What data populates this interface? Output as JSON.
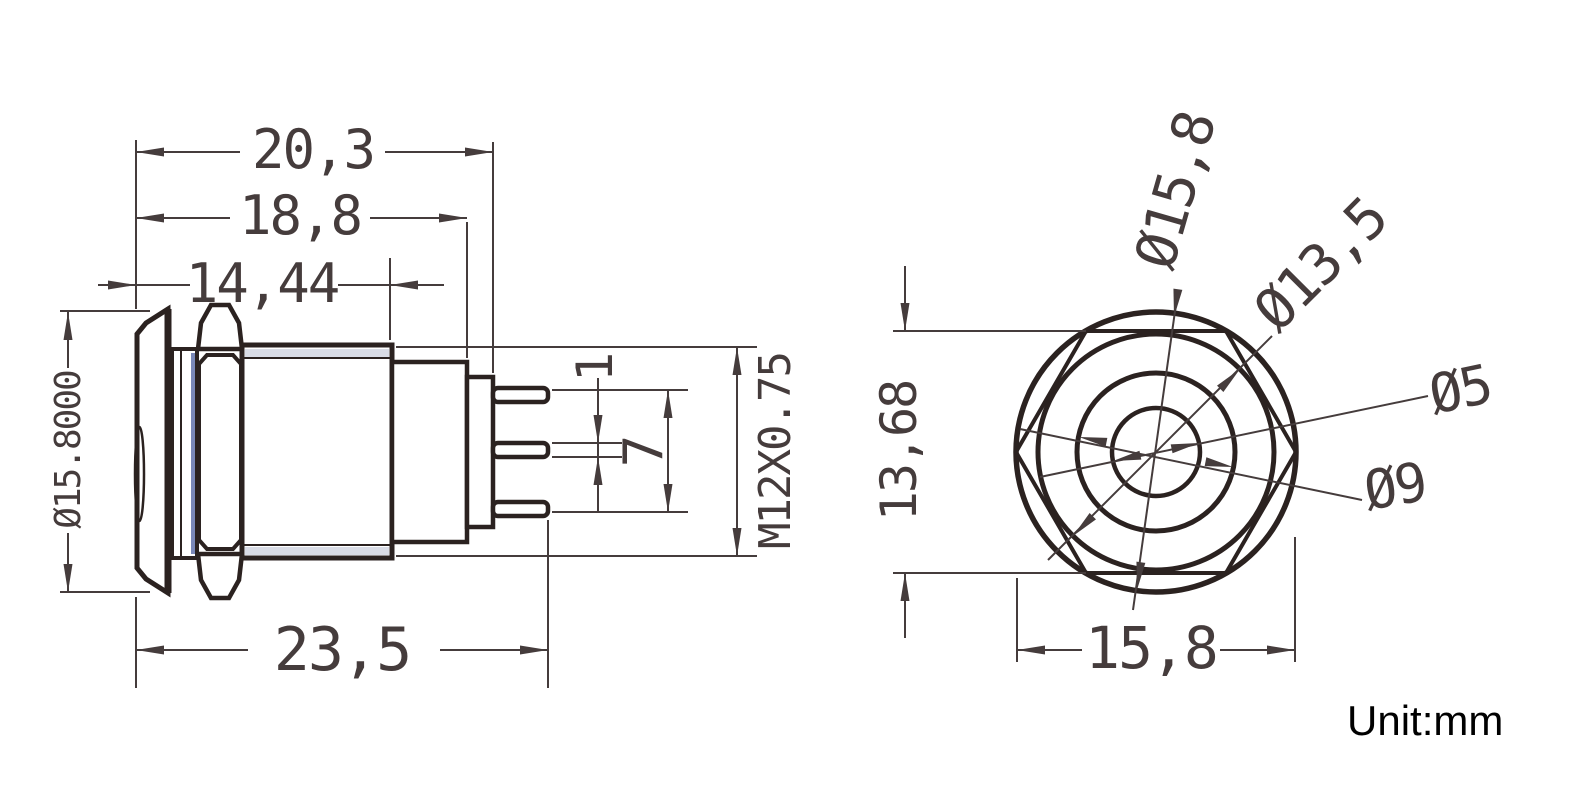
{
  "drawing": {
    "title": "metal push button switch dimensional drawing",
    "unit_note": "Unit:mm",
    "side_view": {
      "width_to_step2": "20,3",
      "width_to_step1": "18,8",
      "width_body": "14,44",
      "width_total": "23,5",
      "cap_diameter": "Ø15.8000",
      "pin_thickness": "1",
      "pin_span": "7",
      "thread_spec": "M12X0.75"
    },
    "front_view": {
      "cap_diameter": "Ø15,8",
      "flange_diameter": "Ø13,5",
      "center_hole_diameter": "Ø5",
      "button_diameter": "Ø9",
      "hex_across_flats": "13,68",
      "overall_width": "15,8"
    },
    "colors": {
      "object_line": "#2b2220",
      "dimension_line": "#453c3c",
      "washer_gray": "#b3b1b0",
      "gasket_blue": "#7a88b8",
      "thread_tint": "#d9dce6"
    }
  }
}
